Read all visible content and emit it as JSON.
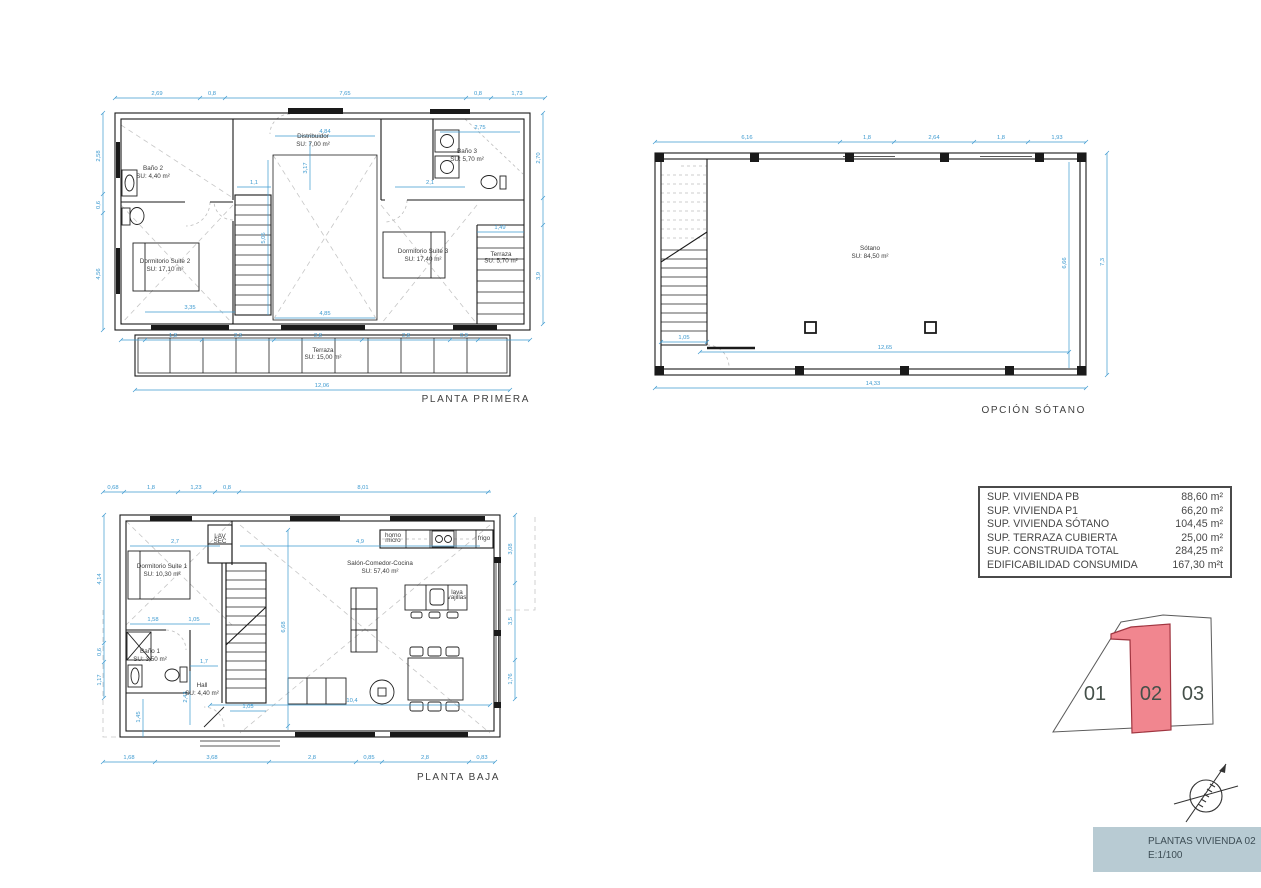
{
  "colors": {
    "dimension": "#3d9ad0",
    "wall": "#1a1a1a",
    "label": "#3a3a3a",
    "highlight_fill": "#f1868f",
    "highlight_stroke": "#a03540",
    "titleblock_bg": "#b8cbd3",
    "titleblock_text": "#3d4d55"
  },
  "plans": {
    "planta_primera": {
      "title": "PLANTA PRIMERA",
      "rooms": [
        {
          "x": 68,
          "y": 90,
          "name": "Baño 2",
          "area": "SU: 4,40 m²"
        },
        {
          "x": 228,
          "y": 58,
          "name": "Distribuidor",
          "area": "SU: 7,00 m²"
        },
        {
          "x": 382,
          "y": 73,
          "name": "Baño 3",
          "area": "SU: 5,70 m²"
        },
        {
          "x": 80,
          "y": 183,
          "name": "Dormitorio Suite 2",
          "area": "SU: 17,10 m²"
        },
        {
          "x": 338,
          "y": 173,
          "name": "Dormitorio Suite 3",
          "area": "SU: 17,40 m²"
        },
        {
          "x": 416,
          "y": 176,
          "name": "Terraza",
          "area": "SU: 5,70 m²",
          "fs": 4.8
        },
        {
          "x": 238,
          "y": 272,
          "name": "Terraza",
          "area": "SU: 15,00 m²",
          "fs": 5.5
        }
      ],
      "dims": [
        {
          "x": 72,
          "y": 15,
          "v": "2,69"
        },
        {
          "x": 127,
          "y": 15,
          "v": "0,8"
        },
        {
          "x": 260,
          "y": 15,
          "v": "7,65"
        },
        {
          "x": 393,
          "y": 15,
          "v": "0,8"
        },
        {
          "x": 432,
          "y": 15,
          "v": "1,73"
        },
        {
          "x": 15,
          "y": 76,
          "v": "2,58",
          "r": 1
        },
        {
          "x": 15,
          "y": 125,
          "v": "0,6",
          "r": 1
        },
        {
          "x": 15,
          "y": 194,
          "v": "4,56",
          "r": 1
        },
        {
          "x": 455,
          "y": 78,
          "v": "2,70",
          "r": 1
        },
        {
          "x": 455,
          "y": 196,
          "v": "3,9",
          "r": 1
        },
        {
          "x": 88,
          "y": 257,
          "v": "1,8"
        },
        {
          "x": 153,
          "y": 257,
          "v": "2,3"
        },
        {
          "x": 233,
          "y": 257,
          "v": "2,8"
        },
        {
          "x": 321,
          "y": 257,
          "v": "2,8"
        },
        {
          "x": 379,
          "y": 257,
          "v": "0,9"
        },
        {
          "x": 237,
          "y": 307,
          "v": "12,06"
        },
        {
          "x": 240,
          "y": 53,
          "v": "4,84"
        },
        {
          "x": 395,
          "y": 49,
          "v": "2,75"
        },
        {
          "x": 169,
          "y": 104,
          "v": "1,1"
        },
        {
          "x": 345,
          "y": 104,
          "v": "2,1"
        },
        {
          "x": 415,
          "y": 149,
          "v": "1,49"
        },
        {
          "x": 105,
          "y": 229,
          "v": "3,35"
        },
        {
          "x": 240,
          "y": 235,
          "v": "4,85"
        },
        {
          "x": 180,
          "y": 158,
          "v": "5,05",
          "r": 1
        },
        {
          "x": 222,
          "y": 88,
          "v": "3,17",
          "r": 1
        }
      ]
    },
    "opcion_sotano": {
      "title": "OPCIÓN SÓTANO",
      "rooms": [
        {
          "x": 225,
          "y": 120,
          "name": "Sótano",
          "area": "SU: 84,50 m²"
        }
      ],
      "dims": [
        {
          "x": 102,
          "y": 9,
          "v": "6,16"
        },
        {
          "x": 222,
          "y": 9,
          "v": "1,8"
        },
        {
          "x": 289,
          "y": 9,
          "v": "2,64"
        },
        {
          "x": 356,
          "y": 9,
          "v": "1,8"
        },
        {
          "x": 412,
          "y": 9,
          "v": "1,93"
        },
        {
          "x": 459,
          "y": 132,
          "v": "7,3",
          "r": 1
        },
        {
          "x": 421,
          "y": 133,
          "v": "6,66",
          "r": 1
        },
        {
          "x": 240,
          "y": 219,
          "v": "12,65"
        },
        {
          "x": 228,
          "y": 255,
          "v": "14,33"
        },
        {
          "x": 39,
          "y": 209,
          "v": "1,05"
        }
      ]
    },
    "planta_baja": {
      "title": "PLANTA BAJA",
      "rooms": [
        {
          "x": 72,
          "y": 93,
          "name": "Dormitorio Suite 1",
          "area": "SU: 10,30 m²"
        },
        {
          "x": 60,
          "y": 178,
          "name": "Baño 1",
          "area": "SU: 3,50 m²"
        },
        {
          "x": 112,
          "y": 212,
          "name": "Hall",
          "area": "SU: 4,40 m²"
        },
        {
          "x": 290,
          "y": 90,
          "name": "Salón-Comedor-Cocina",
          "area": "SU: 57,40 m²"
        },
        {
          "x": 303,
          "y": 62,
          "name": "horno",
          "area": "micro",
          "fs": 3.2
        },
        {
          "x": 394,
          "y": 65,
          "name": "frigo",
          "fs": 3.2
        },
        {
          "x": 367,
          "y": 119,
          "name": "lava",
          "area": "vajillas",
          "fs": 3.2
        },
        {
          "x": 130,
          "y": 63,
          "name": "LAV",
          "area": "SEC",
          "fs": 3.2
        }
      ],
      "dims": [
        {
          "x": 23,
          "y": 14,
          "v": "0,68"
        },
        {
          "x": 61,
          "y": 14,
          "v": "1,8"
        },
        {
          "x": 106,
          "y": 14,
          "v": "1,23"
        },
        {
          "x": 137,
          "y": 14,
          "v": "0,8"
        },
        {
          "x": 273,
          "y": 14,
          "v": "8,01"
        },
        {
          "x": 11,
          "y": 104,
          "v": "4,14",
          "r": 1
        },
        {
          "x": 11,
          "y": 177,
          "v": "0,6",
          "r": 1
        },
        {
          "x": 11,
          "y": 205,
          "v": "1,17",
          "r": 1
        },
        {
          "x": 39,
          "y": 284,
          "v": "1,68"
        },
        {
          "x": 122,
          "y": 284,
          "v": "3,68"
        },
        {
          "x": 222,
          "y": 284,
          "v": "2,8"
        },
        {
          "x": 279,
          "y": 284,
          "v": "0,85"
        },
        {
          "x": 335,
          "y": 284,
          "v": "2,8"
        },
        {
          "x": 392,
          "y": 284,
          "v": "0,83"
        },
        {
          "x": 422,
          "y": 74,
          "v": "3,08",
          "r": 1
        },
        {
          "x": 422,
          "y": 146,
          "v": "3,5",
          "r": 1
        },
        {
          "x": 422,
          "y": 204,
          "v": "1,76",
          "r": 1
        },
        {
          "x": 85,
          "y": 68,
          "v": "2,7"
        },
        {
          "x": 270,
          "y": 68,
          "v": "4,9"
        },
        {
          "x": 63,
          "y": 146,
          "v": "1,58"
        },
        {
          "x": 104,
          "y": 146,
          "v": "1,05"
        },
        {
          "x": 114,
          "y": 188,
          "v": "1,7"
        },
        {
          "x": 97,
          "y": 222,
          "v": "2,43",
          "r": 1
        },
        {
          "x": 158,
          "y": 233,
          "v": "1,05"
        },
        {
          "x": 262,
          "y": 227,
          "v": "10,4"
        },
        {
          "x": 195,
          "y": 152,
          "v": "6,68",
          "r": 1
        },
        {
          "x": 50,
          "y": 242,
          "v": "1,45",
          "r": 1
        }
      ]
    }
  },
  "areas_table": {
    "rows": [
      {
        "label": "SUP. VIVIENDA PB",
        "value": "88,60 m²"
      },
      {
        "label": "SUP. VIVIENDA P1",
        "value": "66,20 m²"
      },
      {
        "label": "SUP. VIVIENDA SÓTANO",
        "value": "104,45 m²"
      },
      {
        "label": "SUP. TERRAZA CUBIERTA",
        "value": "25,00 m²"
      },
      {
        "label": "SUP. CONSTRUIDA TOTAL",
        "value": "284,25 m²"
      },
      {
        "label": "EDIFICABILIDAD CONSUMIDA",
        "value": "167,30 m²t"
      }
    ]
  },
  "plot_diagram": {
    "units": [
      "01",
      "02",
      "03"
    ],
    "highlighted_unit": "02"
  },
  "title_block": {
    "line1": "PLANTAS VIVIENDA 02",
    "line2": "E:1/100"
  }
}
